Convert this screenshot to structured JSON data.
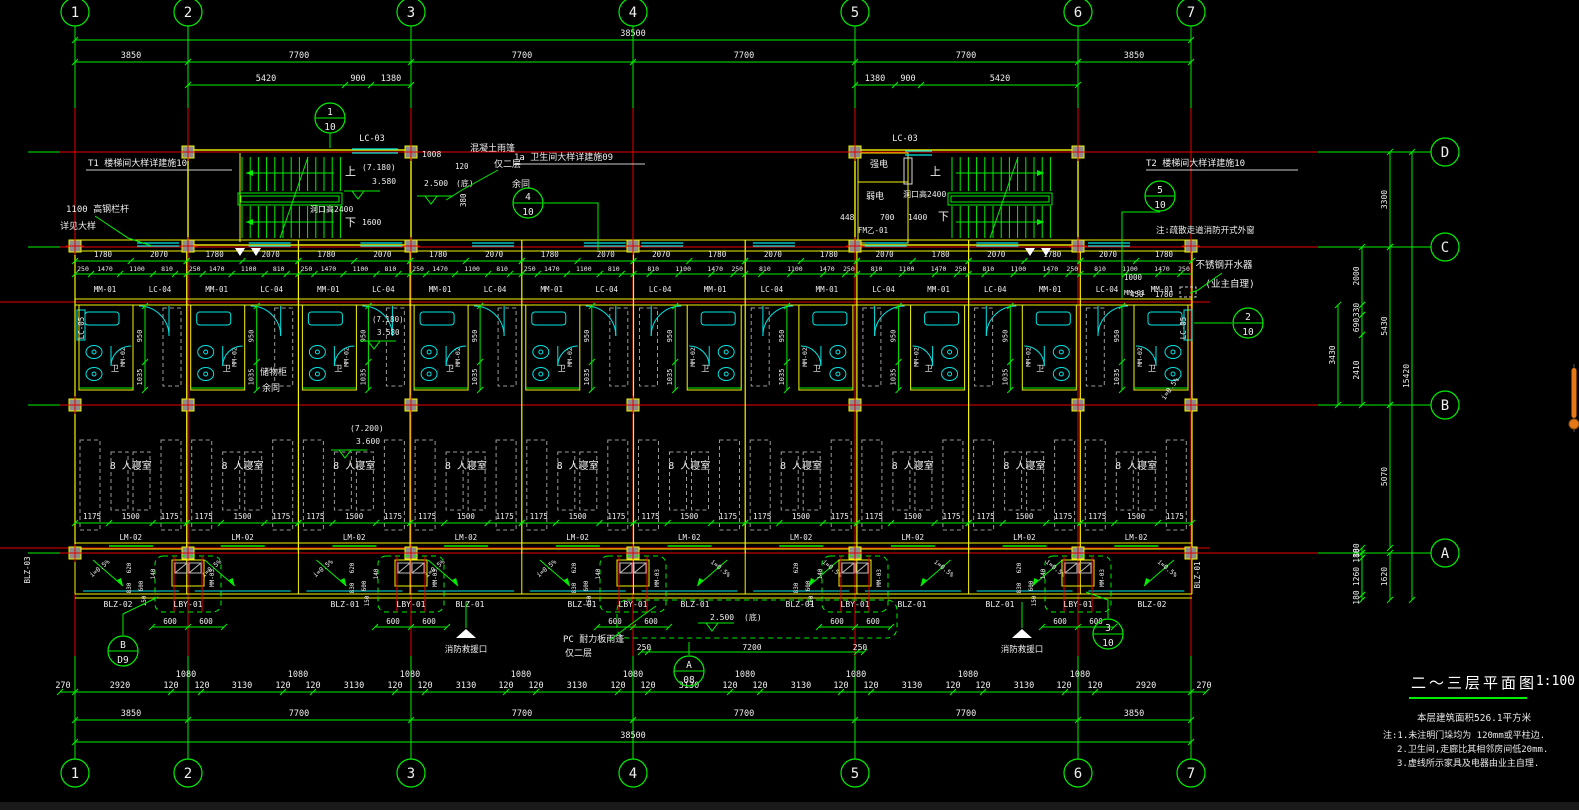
{
  "palette": {
    "green": "#00f000",
    "yellow": "#f5f500",
    "red": "#e80000",
    "cyan": "#00e6e6",
    "white": "#efefef",
    "gray": "#9a9a9a",
    "colfill": "#8c8c8c",
    "orange": "#e67817"
  },
  "title_block": {
    "title": "二～三层平面图",
    "scale": "1:100",
    "area": "本层建筑面积526.1平方米",
    "notes": [
      "注:1.未注明门垛均为  120mm或平柱边.",
      "2.卫生间,走廊比其相邻房间低20mm.",
      "3.虚线所示家具及电器由业主自理."
    ]
  },
  "grid": {
    "cols": [
      {
        "label": "1",
        "x": 75
      },
      {
        "label": "2",
        "x": 188
      },
      {
        "label": "3",
        "x": 411
      },
      {
        "label": "4",
        "x": 633
      },
      {
        "label": "5",
        "x": 855
      },
      {
        "label": "6",
        "x": 1078
      },
      {
        "label": "7",
        "x": 1191
      }
    ],
    "rows": [
      {
        "label": "D",
        "y": 152
      },
      {
        "label": "C",
        "y": 247
      },
      {
        "label": "B",
        "y": 405
      },
      {
        "label": "A",
        "y": 553
      }
    ],
    "top_bubble_y": 12,
    "bot_bubble_y": 773,
    "right_bubble_x": 1445
  },
  "dims_top": [
    {
      "line_y": 40,
      "label_y": 36,
      "spans": [
        [
          75,
          1191
        ]
      ],
      "ticks": [
        75,
        1191
      ],
      "labels": [
        [
          633,
          "38500"
        ]
      ]
    },
    {
      "line_y": 62,
      "label_y": 58,
      "spans": [
        [
          75,
          1191
        ]
      ],
      "ticks": [
        75,
        188,
        411,
        633,
        855,
        1078,
        1191
      ],
      "labels": [
        [
          131,
          "3850"
        ],
        [
          299,
          "7700"
        ],
        [
          522,
          "7700"
        ],
        [
          744,
          "7700"
        ],
        [
          966,
          "7700"
        ],
        [
          1134,
          "3850"
        ]
      ]
    },
    {
      "line_y": 85,
      "label_y": 81,
      "spans": [
        [
          188,
          411
        ],
        [
          855,
          1078
        ]
      ],
      "ticks": [
        188,
        345,
        371,
        411,
        855,
        895,
        921,
        1078
      ],
      "labels": [
        [
          266,
          "5420"
        ],
        [
          358,
          "900"
        ],
        [
          391,
          "1380"
        ],
        [
          875,
          "1380"
        ],
        [
          908,
          "900"
        ],
        [
          1000,
          "5420"
        ]
      ]
    }
  ],
  "dims_bottom": [
    {
      "line_y": 692,
      "label_y": 688,
      "spans": [
        [
          60,
          1206
        ]
      ],
      "ticks": [
        60,
        75,
        1191,
        1206
      ],
      "labels": [
        [
          63,
          "270"
        ],
        [
          120,
          "2920"
        ],
        [
          171,
          "120"
        ],
        [
          186,
          "1080",
          -11
        ],
        [
          202,
          "120"
        ],
        [
          242,
          "3130"
        ],
        [
          283,
          "120"
        ],
        [
          298,
          "1080",
          -11
        ],
        [
          313,
          "120"
        ],
        [
          354,
          "3130"
        ],
        [
          395,
          "120"
        ],
        [
          410,
          "1080",
          -11
        ],
        [
          425,
          "120"
        ],
        [
          466,
          "3130"
        ],
        [
          506,
          "120"
        ],
        [
          521,
          "1080",
          -11
        ],
        [
          536,
          "120"
        ],
        [
          577,
          "3130"
        ],
        [
          618,
          "120"
        ],
        [
          633,
          "1080",
          -11
        ],
        [
          648,
          "120"
        ],
        [
          689,
          "3130"
        ],
        [
          730,
          "120"
        ],
        [
          745,
          "1080",
          -11
        ],
        [
          760,
          "120"
        ],
        [
          801,
          "3130"
        ],
        [
          841,
          "120"
        ],
        [
          856,
          "1080",
          -11
        ],
        [
          871,
          "120"
        ],
        [
          912,
          "3130"
        ],
        [
          953,
          "120"
        ],
        [
          968,
          "1080",
          -11
        ],
        [
          983,
          "120"
        ],
        [
          1024,
          "3130"
        ],
        [
          1064,
          "120"
        ],
        [
          1080,
          "1080",
          -11
        ],
        [
          1095,
          "120"
        ],
        [
          1146,
          "2920"
        ],
        [
          1204,
          "270"
        ]
      ]
    },
    {
      "line_y": 720,
      "label_y": 716,
      "spans": [
        [
          75,
          1191
        ]
      ],
      "ticks": [
        75,
        188,
        411,
        633,
        855,
        1078,
        1191
      ],
      "labels": [
        [
          131,
          "3850"
        ],
        [
          299,
          "7700"
        ],
        [
          522,
          "7700"
        ],
        [
          744,
          "7700"
        ],
        [
          966,
          "7700"
        ],
        [
          1134,
          "3850"
        ]
      ]
    },
    {
      "line_y": 742,
      "label_y": 738,
      "spans": [
        [
          75,
          1191
        ]
      ],
      "ticks": [
        75,
        1191
      ],
      "labels": [
        [
          633,
          "38500"
        ]
      ]
    }
  ],
  "dims_right": [
    {
      "line_x": 1390,
      "segs": [
        [
          152,
          247,
          "3300"
        ],
        [
          247,
          405,
          "5430"
        ],
        [
          405,
          548,
          "5070"
        ],
        [
          553,
          600,
          "1620"
        ]
      ]
    },
    {
      "line_x": 1362,
      "segs": [
        [
          247,
          305,
          "2000"
        ],
        [
          305,
          315,
          "330"
        ],
        [
          315,
          335,
          "690"
        ],
        [
          335,
          405,
          "2410"
        ],
        [
          548,
          553,
          "180"
        ],
        [
          553,
          558,
          "180"
        ],
        [
          558,
          595,
          "1260"
        ],
        [
          595,
          600,
          "180"
        ]
      ]
    },
    {
      "line_x": 1338,
      "segs": [
        [
          305,
          405,
          "3430"
        ]
      ]
    },
    {
      "line_x": 1412,
      "segs": [
        [
          152,
          600,
          "15420"
        ]
      ]
    }
  ],
  "corridor": {
    "line1_y": 261,
    "lab1_y": 257,
    "row1": [
      "1780",
      "2070"
    ],
    "line2_y": 274,
    "lab2_y": 271,
    "row2": [
      "250",
      "1470",
      "1100",
      "810"
    ],
    "tag_y": 292,
    "tags": [
      "MM-01",
      "LC-04"
    ]
  },
  "units": {
    "x0": 75,
    "w": 111.7,
    "count": 10,
    "mirror_from": 5,
    "room_label": "8 人寝室",
    "room_dims": [
      "1175",
      "1500",
      "1175"
    ],
    "dim_label_y": 519,
    "door_label": "LM-02",
    "bath_wc": "卫",
    "bath_door_tag": "MM-02",
    "bath_dims": [
      "950",
      "1035"
    ]
  },
  "balcony": {
    "lby_xs": [
      188,
      411,
      633,
      855,
      1078
    ],
    "lby_label": "LBY-01",
    "lby_dims": [
      "600",
      "600"
    ],
    "window_tag": "MM-03",
    "side_dims": [
      "620",
      "830",
      "600",
      "140"
    ],
    "gap_dim": "150",
    "slope_label": "i=0.5%",
    "label_y": 607,
    "labels_row": [
      [
        118,
        "BLZ-02"
      ],
      [
        345,
        "BLZ-01"
      ],
      [
        470,
        "BLZ-01"
      ],
      [
        582,
        "BLZ-01"
      ],
      [
        695,
        "BLZ-01"
      ],
      [
        800,
        "BLZ-01"
      ],
      [
        912,
        "BLZ-01"
      ],
      [
        1000,
        "BLZ-01"
      ],
      [
        1152,
        "BLZ-02"
      ]
    ],
    "left_edge_tag": "BLZ-03",
    "right_edge_tag": "BLZ-01",
    "rescue_xs": [
      466,
      1022
    ],
    "rescue_label": "消防救援口"
  },
  "detail_bubbles": [
    {
      "x": 330,
      "y": 118,
      "a": "1",
      "b": "10"
    },
    {
      "x": 528,
      "y": 203,
      "a": "4",
      "b": "10"
    },
    {
      "x": 1160,
      "y": 196,
      "a": "5",
      "b": "10"
    },
    {
      "x": 1248,
      "y": 323,
      "a": "2",
      "b": "10"
    },
    {
      "x": 689,
      "y": 671,
      "a": "A",
      "b": "08"
    },
    {
      "x": 123,
      "y": 651,
      "a": "B",
      "b": "D9"
    },
    {
      "x": 1108,
      "y": 634,
      "a": "3",
      "b": "10"
    }
  ],
  "annotations": [
    {
      "x": 88,
      "y": 166,
      "t": "T1 楼梯间大样详建施10",
      "s": 9,
      "u": [
        86,
        170,
        232
      ]
    },
    {
      "x": 66,
      "y": 212,
      "t": "1100  高钢栏杆",
      "s": 9
    },
    {
      "x": 60,
      "y": 229,
      "t": "详见大样",
      "s": 9
    },
    {
      "x": 372,
      "y": 141,
      "t": "LC-03",
      "s": 8.5,
      "a": "m"
    },
    {
      "x": 345,
      "y": 175,
      "t": "上",
      "s": 11
    },
    {
      "x": 345,
      "y": 226,
      "t": "下",
      "s": 11
    },
    {
      "x": 362,
      "y": 170,
      "t": "(7.180)",
      "s": 8
    },
    {
      "x": 372,
      "y": 184,
      "t": "3.580",
      "s": 8
    },
    {
      "x": 310,
      "y": 212,
      "t": "洞口高2400",
      "s": 8
    },
    {
      "x": 362,
      "y": 225,
      "t": "1600",
      "s": 8
    },
    {
      "x": 422,
      "y": 157,
      "t": "1008",
      "s": 8
    },
    {
      "x": 455,
      "y": 169,
      "t": "120",
      "s": 7.5
    },
    {
      "x": 424,
      "y": 186,
      "t": "2.500",
      "s": 8
    },
    {
      "x": 456,
      "y": 186,
      "t": "(底)",
      "s": 8
    },
    {
      "x": 466,
      "y": 207,
      "t": "380",
      "s": 7.5,
      "r": -90
    },
    {
      "x": 470,
      "y": 151,
      "t": "混凝土雨篷",
      "s": 9
    },
    {
      "x": 494,
      "y": 167,
      "t": "仅二层",
      "s": 9
    },
    {
      "x": 514,
      "y": 160,
      "t": "1a 卫生间大样详建施09",
      "s": 9,
      "u": [
        514,
        164,
        645
      ]
    },
    {
      "x": 512,
      "y": 187,
      "t": "余同",
      "s": 9
    },
    {
      "x": 905,
      "y": 141,
      "t": "LC-03",
      "s": 8.5,
      "a": "m"
    },
    {
      "x": 870,
      "y": 167,
      "t": "强电",
      "s": 9
    },
    {
      "x": 866,
      "y": 199,
      "t": "弱电",
      "s": 9
    },
    {
      "x": 903,
      "y": 197,
      "t": "洞口高2400",
      "s": 8
    },
    {
      "x": 840,
      "y": 220,
      "t": "448",
      "s": 8
    },
    {
      "x": 880,
      "y": 220,
      "t": "700",
      "s": 8
    },
    {
      "x": 908,
      "y": 220,
      "t": "1400",
      "s": 8
    },
    {
      "x": 938,
      "y": 220,
      "t": "下",
      "s": 11
    },
    {
      "x": 930,
      "y": 175,
      "t": "上",
      "s": 11
    },
    {
      "x": 858,
      "y": 233,
      "t": "FM乙-01",
      "s": 7.5
    },
    {
      "x": 1146,
      "y": 166,
      "t": "T2 楼梯间大样详建施10",
      "s": 9,
      "u": [
        1146,
        170,
        1298
      ]
    },
    {
      "x": 1156,
      "y": 233,
      "t": "注:疏散走道消防开式外窗",
      "s": 8.5
    },
    {
      "x": 1224,
      "y": 268,
      "t": "不锈钢开水器",
      "s": 9.5,
      "a": "m"
    },
    {
      "x": 1230,
      "y": 287,
      "t": "(业主自理)",
      "s": 9.5,
      "a": "m"
    },
    {
      "x": 1130,
      "y": 297,
      "t": "450",
      "s": 7.5
    },
    {
      "x": 1155,
      "y": 297,
      "t": "1780",
      "s": 7.5
    },
    {
      "x": 1124,
      "y": 280,
      "t": "1000",
      "s": 7.5
    },
    {
      "x": 1124,
      "y": 295,
      "t": "MM-01",
      "s": 7
    },
    {
      "x": 1172,
      "y": 390,
      "t": "i=0.5%",
      "s": 7,
      "r": -55,
      "a": "m"
    },
    {
      "x": 260,
      "y": 375,
      "t": "储物柜",
      "s": 9
    },
    {
      "x": 262,
      "y": 391,
      "t": "余同",
      "s": 9
    },
    {
      "x": 372,
      "y": 322,
      "t": "(7.180)",
      "s": 7.5
    },
    {
      "x": 377,
      "y": 335,
      "t": "3.580",
      "s": 7.5
    },
    {
      "x": 350,
      "y": 431,
      "t": "(7.200)",
      "s": 8
    },
    {
      "x": 356,
      "y": 444,
      "t": "3.600",
      "s": 8
    },
    {
      "x": 563,
      "y": 642,
      "t": "PC 耐力板雨篷",
      "s": 9
    },
    {
      "x": 565,
      "y": 656,
      "t": "仅二层",
      "s": 9
    },
    {
      "x": 710,
      "y": 620,
      "t": "2.500",
      "s": 8
    },
    {
      "x": 744,
      "y": 620,
      "t": "(底)",
      "s": 8
    },
    {
      "x": 644,
      "y": 650,
      "t": "250",
      "s": 8,
      "a": "m"
    },
    {
      "x": 752,
      "y": 650,
      "t": "7200",
      "s": 8,
      "a": "m"
    },
    {
      "x": 860,
      "y": 650,
      "t": "250",
      "s": 8,
      "a": "m"
    },
    {
      "x": 84,
      "y": 328,
      "t": "LC-05",
      "s": 7.5,
      "r": -90,
      "a": "m"
    },
    {
      "x": 1186,
      "y": 328,
      "t": "LC-05",
      "s": 7.5,
      "r": -90,
      "a": "m"
    },
    {
      "x": 30,
      "y": 570,
      "t": "BLZ-03",
      "s": 7.5,
      "r": -90,
      "a": "m"
    },
    {
      "x": 1200,
      "y": 575,
      "t": "BLZ-01",
      "s": 7.5,
      "r": -90,
      "a": "m"
    }
  ],
  "leaders": [
    [
      [
        95,
        216
      ],
      [
        128,
        238
      ],
      [
        152,
        246
      ]
    ],
    [
      [
        544,
        203
      ],
      [
        598,
        203
      ],
      [
        598,
        250
      ]
    ],
    [
      [
        498,
        170
      ],
      [
        462,
        190
      ],
      [
        446,
        200
      ]
    ],
    [
      [
        1160,
        212
      ],
      [
        1122,
        212
      ],
      [
        1122,
        298
      ]
    ],
    [
      [
        1232,
        323
      ],
      [
        1194,
        323
      ]
    ],
    [
      [
        1222,
        273
      ],
      [
        1198,
        290
      ],
      [
        1190,
        293
      ]
    ],
    [
      [
        610,
        640
      ],
      [
        642,
        616
      ],
      [
        656,
        606
      ]
    ],
    [
      [
        689,
        655
      ],
      [
        689,
        642
      ]
    ],
    [
      [
        123,
        635
      ],
      [
        123,
        614
      ],
      [
        158,
        597
      ]
    ],
    [
      [
        1108,
        618
      ],
      [
        1108,
        600
      ],
      [
        1086,
        592
      ]
    ],
    [
      [
        330,
        133
      ],
      [
        330,
        148
      ]
    ],
    [
      [
        466,
        628
      ],
      [
        466,
        602
      ]
    ],
    [
      [
        1022,
        628
      ],
      [
        1022,
        602
      ]
    ]
  ],
  "level_symbols": [
    [
      358,
      191
    ],
    [
      431,
      196
    ],
    [
      345,
      450
    ],
    [
      374,
      341
    ],
    [
      712,
      623
    ]
  ],
  "section_marks": [
    [
      240,
      254
    ],
    [
      256,
      254
    ],
    [
      1030,
      254
    ],
    [
      1046,
      254
    ]
  ],
  "scrollbar": {
    "x": 1574,
    "y1": 368,
    "y2": 418,
    "ball_y": 424
  }
}
